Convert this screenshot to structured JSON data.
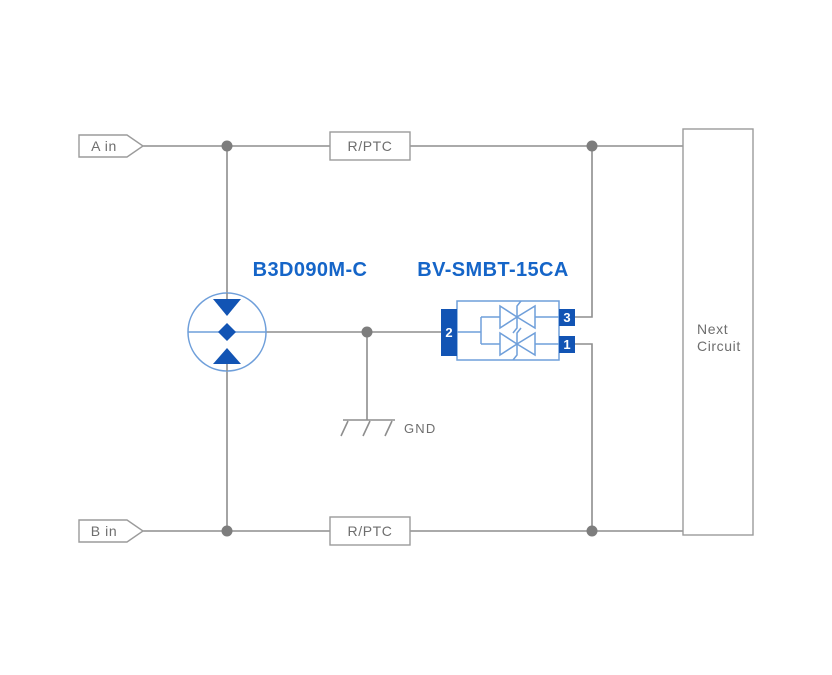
{
  "colors": {
    "wire": "#8e8e8e",
    "junction": "#7d7d7d",
    "outline": "#9b9b9b",
    "gray_text": "#6e6e6e",
    "blue_text": "#1565c8",
    "blue_fill": "#1254b4",
    "light_blue": "#6f9fda"
  },
  "connectors": {
    "input_a": "A in",
    "input_b": "B in"
  },
  "components": {
    "rptc_top": {
      "label": "R/PTC"
    },
    "rptc_bottom": {
      "label": "R/PTC"
    },
    "gdt": {
      "part_number": "B3D090M-C"
    },
    "tvs": {
      "part_number": "BV-SMBT-15CA",
      "pin_left": "2",
      "pin_top_right": "3",
      "pin_bottom_right": "1"
    },
    "ground": {
      "label": "GND"
    },
    "next_circuit": {
      "line1": "Next",
      "line2": "Circuit"
    }
  }
}
